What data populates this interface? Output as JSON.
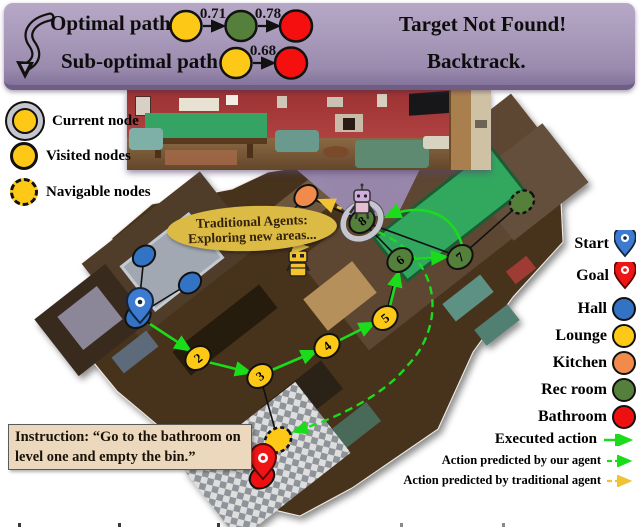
{
  "banner": {
    "optimal_label": "Optimal path:",
    "suboptimal_label": "Sub-optimal path:",
    "optimal_weight_1": "0.71",
    "optimal_weight_2": "0.78",
    "suboptimal_weight": "0.68",
    "result_top": "Target Not Found!",
    "result_bottom": "Backtrack.",
    "bg_color": "#a899ba"
  },
  "node_legend": {
    "current": "Current node",
    "visited": "Visited nodes",
    "navigable": "Navigable nodes"
  },
  "map_legend": {
    "start": "Start",
    "goal": "Goal",
    "hall": "Hall",
    "lounge": "Lounge",
    "kitchen": "Kitchen",
    "rec_room": "Rec room",
    "bathroom": "Bathroom",
    "executed": "Executed action",
    "our_agent": "Action predicted by our agent",
    "traditional_agent": "Action predicted by traditional agent"
  },
  "speech_bubble": {
    "line1": "Traditional Agents:",
    "line2": "Exploring new areas..."
  },
  "instruction": {
    "text": "Instruction: “Go to the bathroom on level one and empty the bin.”"
  },
  "graph": {
    "node_labels": [
      "1",
      "2",
      "3",
      "4",
      "5",
      "6",
      "7",
      "8"
    ]
  },
  "colors": {
    "hall_blue": "#3273c4",
    "lounge_yellow": "#fec817",
    "kitchen_orange": "#f08b4b",
    "rec_green": "#55803c",
    "bathroom_red": "#ee1010",
    "executed_green": "#1bdc1b",
    "traditional_yellow": "#f0c335",
    "banner_purple": "#a899ba",
    "bubble_yellow": "#dcbb45",
    "instruction_tan": "#ecd9bd"
  }
}
